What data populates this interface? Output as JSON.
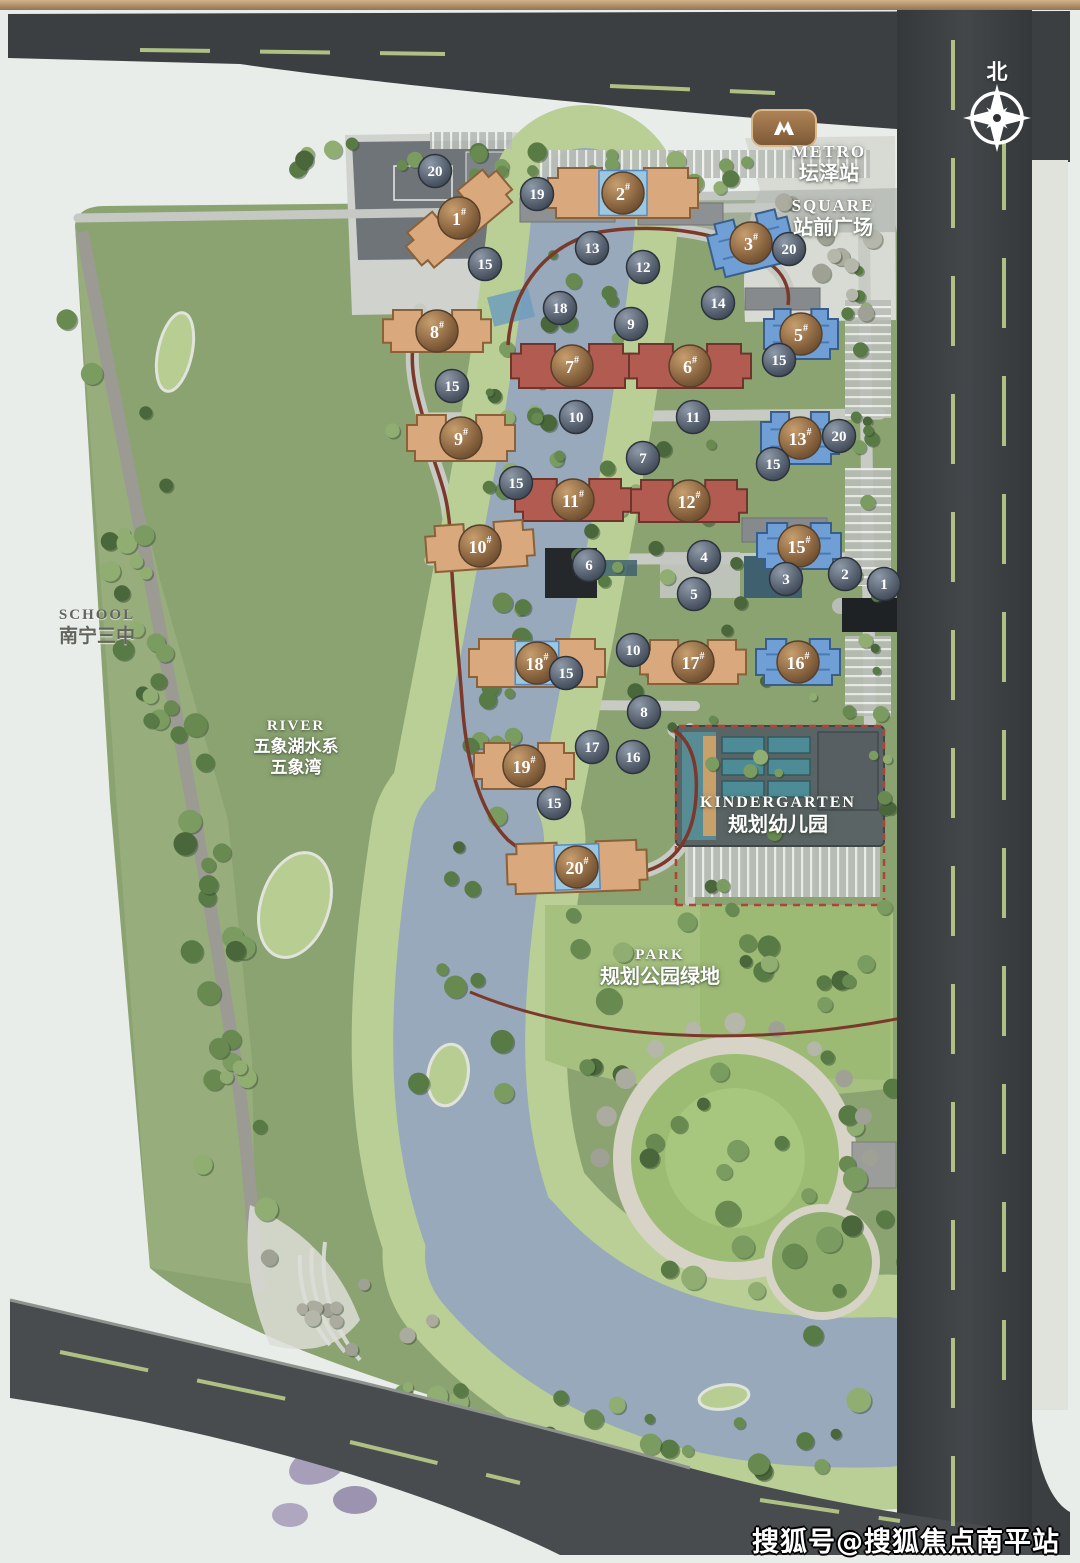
{
  "canvas": {
    "w": 1080,
    "h": 1563
  },
  "labels": {
    "metro": {
      "en": "METRO",
      "zh": "坛泽站",
      "x": 829,
      "y": 141
    },
    "square": {
      "en": "SQUARE",
      "zh": "站前广场",
      "x": 833,
      "y": 195
    },
    "school": {
      "en": "SCHOOL",
      "zh": "南宁三中",
      "x": 97,
      "y": 606
    },
    "river": {
      "en": "RIVER",
      "zh1": "五象湖水系",
      "zh2": "五象湾",
      "x": 296,
      "y": 717
    },
    "kindergarten": {
      "en": "KINDERGARTEN",
      "zh": "规划幼儿园",
      "x": 778,
      "y": 793
    },
    "park": {
      "en": "PARK",
      "zh": "规划公园绿地",
      "x": 660,
      "y": 946
    },
    "north": {
      "text": "北",
      "x": 997,
      "y": 56
    }
  },
  "watermark": {
    "text": "搜狐号@搜狐焦点南平站"
  },
  "metro_badge": {
    "icon": "metro-logo",
    "x": 785,
    "y": 128
  },
  "buildings": [
    {
      "label": "1",
      "x": 459,
      "y": 218,
      "rot": -40,
      "w": 118,
      "h": 44,
      "type": "orange"
    },
    {
      "label": "2",
      "x": 623,
      "y": 193,
      "rot": 0,
      "w": 150,
      "h": 50,
      "type": "orange-blue"
    },
    {
      "label": "3",
      "x": 751,
      "y": 243,
      "rot": -14,
      "w": 82,
      "h": 54,
      "type": "blue"
    },
    {
      "label": "5",
      "x": 801,
      "y": 334,
      "rot": 0,
      "w": 74,
      "h": 50,
      "type": "blue"
    },
    {
      "label": "7",
      "x": 572,
      "y": 366,
      "rot": 0,
      "w": 122,
      "h": 44,
      "type": "red"
    },
    {
      "label": "6",
      "x": 690,
      "y": 366,
      "rot": 0,
      "w": 122,
      "h": 44,
      "type": "red"
    },
    {
      "label": "8",
      "x": 437,
      "y": 331,
      "rot": 0,
      "w": 108,
      "h": 42,
      "type": "orange"
    },
    {
      "label": "9",
      "x": 461,
      "y": 438,
      "rot": 0,
      "w": 108,
      "h": 46,
      "type": "orange"
    },
    {
      "label": "13",
      "x": 800,
      "y": 438,
      "rot": 0,
      "w": 78,
      "h": 52,
      "type": "blue"
    },
    {
      "label": "11",
      "x": 573,
      "y": 500,
      "rot": 0,
      "w": 116,
      "h": 42,
      "type": "red"
    },
    {
      "label": "12",
      "x": 689,
      "y": 501,
      "rot": 0,
      "w": 116,
      "h": 42,
      "type": "red"
    },
    {
      "label": "10",
      "x": 480,
      "y": 546,
      "rot": -4,
      "w": 108,
      "h": 46,
      "type": "orange"
    },
    {
      "label": "15",
      "x": 799,
      "y": 546,
      "rot": 0,
      "w": 84,
      "h": 46,
      "type": "blue"
    },
    {
      "label": "18",
      "x": 537,
      "y": 663,
      "rot": 0,
      "w": 136,
      "h": 48,
      "type": "orange-blue"
    },
    {
      "label": "17",
      "x": 693,
      "y": 662,
      "rot": 0,
      "w": 106,
      "h": 44,
      "type": "orange"
    },
    {
      "label": "16",
      "x": 798,
      "y": 662,
      "rot": 0,
      "w": 84,
      "h": 46,
      "type": "blue"
    },
    {
      "label": "19",
      "x": 524,
      "y": 766,
      "rot": 0,
      "w": 100,
      "h": 46,
      "type": "orange"
    },
    {
      "label": "20",
      "x": 577,
      "y": 867,
      "rot": -2,
      "w": 140,
      "h": 50,
      "type": "orange-blue"
    }
  ],
  "markers": [
    {
      "n": "20",
      "x": 435,
      "y": 171
    },
    {
      "n": "19",
      "x": 537,
      "y": 194
    },
    {
      "n": "15",
      "x": 485,
      "y": 264
    },
    {
      "n": "13",
      "x": 592,
      "y": 248
    },
    {
      "n": "12",
      "x": 643,
      "y": 267
    },
    {
      "n": "18",
      "x": 560,
      "y": 308
    },
    {
      "n": "9",
      "x": 631,
      "y": 324
    },
    {
      "n": "14",
      "x": 718,
      "y": 303
    },
    {
      "n": "20",
      "x": 789,
      "y": 249
    },
    {
      "n": "15",
      "x": 779,
      "y": 360
    },
    {
      "n": "15",
      "x": 452,
      "y": 386
    },
    {
      "n": "10",
      "x": 576,
      "y": 417
    },
    {
      "n": "11",
      "x": 693,
      "y": 417
    },
    {
      "n": "7",
      "x": 643,
      "y": 458
    },
    {
      "n": "20",
      "x": 839,
      "y": 436
    },
    {
      "n": "15",
      "x": 773,
      "y": 464
    },
    {
      "n": "15",
      "x": 516,
      "y": 483
    },
    {
      "n": "6",
      "x": 589,
      "y": 565
    },
    {
      "n": "4",
      "x": 704,
      "y": 557
    },
    {
      "n": "5",
      "x": 694,
      "y": 594
    },
    {
      "n": "3",
      "x": 786,
      "y": 579
    },
    {
      "n": "2",
      "x": 845,
      "y": 574
    },
    {
      "n": "1",
      "x": 884,
      "y": 584
    },
    {
      "n": "10",
      "x": 633,
      "y": 650
    },
    {
      "n": "15",
      "x": 566,
      "y": 673
    },
    {
      "n": "8",
      "x": 644,
      "y": 712
    },
    {
      "n": "17",
      "x": 592,
      "y": 747
    },
    {
      "n": "16",
      "x": 633,
      "y": 757
    },
    {
      "n": "15",
      "x": 554,
      "y": 803
    }
  ],
  "colors": {
    "bg": "#e8ede9",
    "road": "#3b3f41",
    "road_line": "#aec183",
    "sidewalk": "#dfe3dc",
    "site_green": "#8ba371",
    "bank_green": "#b9cf96",
    "lawn": "#a6c17f",
    "river": "#97a9ba",
    "plaza_light": "#d8dbd4",
    "plaza_dark": "#6e7478",
    "boundary_line": "#7a392b",
    "kindergarten_teal": "#4d8c96",
    "building_orange": "#d9a87c",
    "building_orange_stroke": "#8a6138",
    "building_red": "#b25b50",
    "building_red_stroke": "#6f352c",
    "building_blue": "#6f9fd4",
    "building_blue_stroke": "#3a5e8c",
    "pool_blue": "#9cc7e0",
    "marker_stroke": "#2c333c",
    "badge_stroke": "#58402a"
  }
}
